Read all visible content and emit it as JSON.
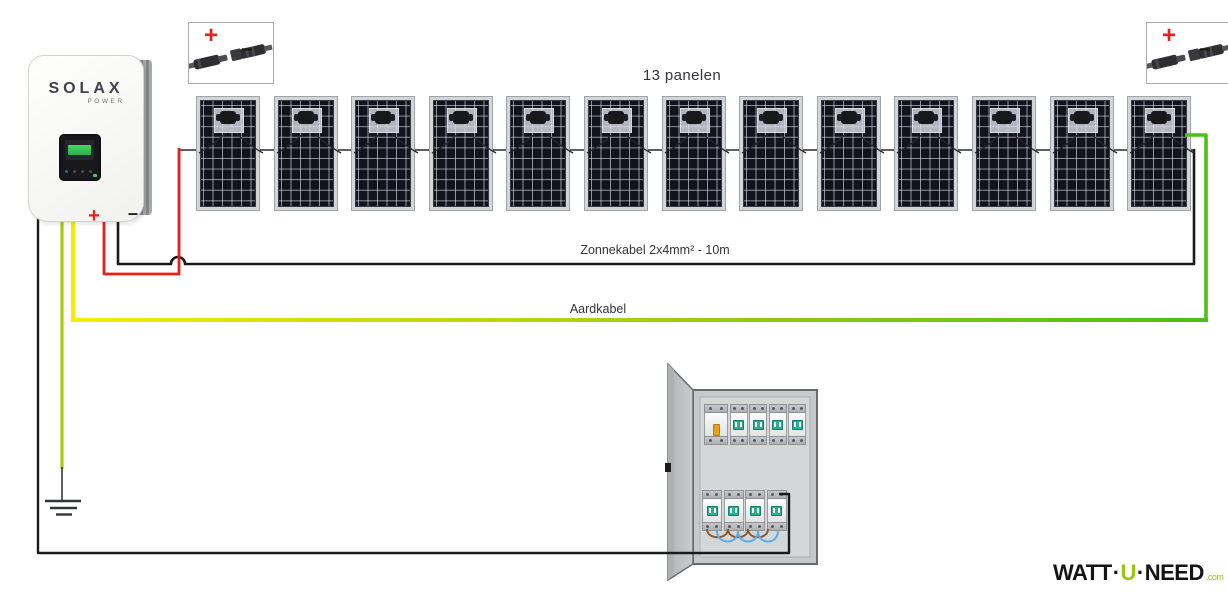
{
  "labels": {
    "panels": "13 panelen",
    "solar_cable": "Zonnekabel 2x4mm² - 10m",
    "ground_cable": "Aardkabel"
  },
  "inverter": {
    "brand": "SOLAX",
    "brand_sub": "POWER",
    "plus": "+",
    "minus": "–"
  },
  "connectors": {
    "plus": "+",
    "minus": "−"
  },
  "panels": {
    "count": 13
  },
  "distribution_box": {
    "top_row": [
      "main-switch",
      "breaker",
      "breaker",
      "breaker",
      "breaker"
    ],
    "bottom_row": [
      "breaker",
      "breaker",
      "breaker",
      "breaker"
    ]
  },
  "logo": {
    "part1": "WATT",
    "dot1": "·",
    "part2": "U",
    "dot2": "·",
    "part3": "NEED",
    "suffix": ".com"
  },
  "colors": {
    "red": "#e8201a",
    "black": "#1a1a1a",
    "yellow": "#f6ec00",
    "green": "#4cc013",
    "ground_wire": "#abc90e",
    "breaker_toggle": "#26b190",
    "main_toggle": "#e8a11e",
    "wire_brown": "#8a5a2a",
    "wire_blue": "#5aaee8",
    "logo_green": "#9bc413"
  }
}
